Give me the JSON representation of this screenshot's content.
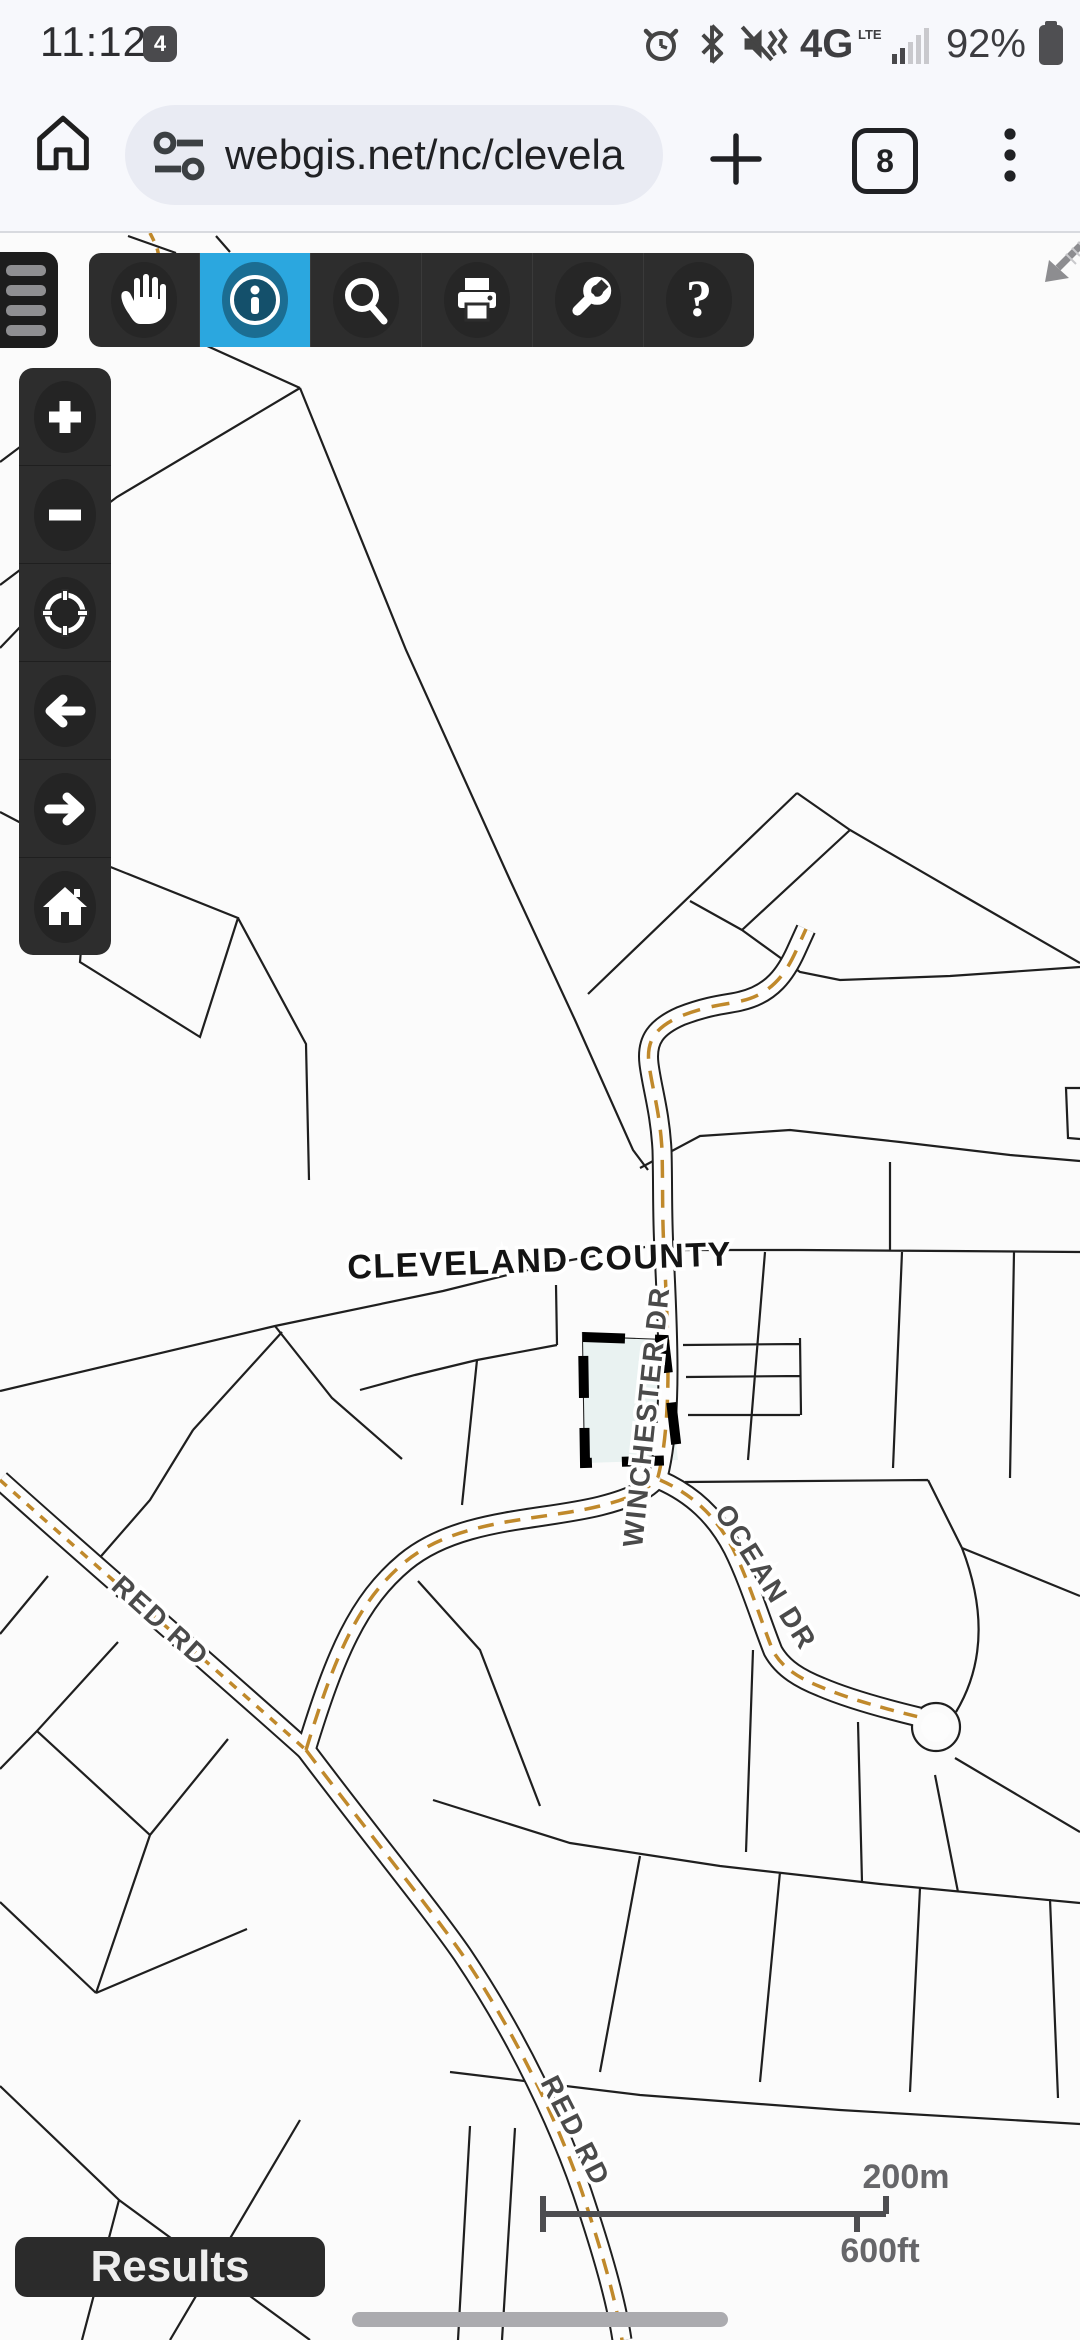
{
  "status_bar": {
    "time": "11:12",
    "notification_badge": "4",
    "network": "4G",
    "network_sub": "LTE",
    "battery_percent": "92%"
  },
  "browser_bar": {
    "url": "webgis.net/nc/clevela",
    "tab_count": "8"
  },
  "map_toolbar": {
    "tools": [
      "pan",
      "identify",
      "search",
      "print",
      "tools",
      "help"
    ],
    "active_tool": "identify"
  },
  "nav_toolbar": {
    "tools": [
      "zoom-in",
      "zoom-out",
      "locate",
      "back",
      "forward",
      "home"
    ]
  },
  "map": {
    "county_label": "CLEVELAND COUNTY",
    "road_labels": {
      "winchester": "WINCHESTER DR",
      "ocean": "OCEAN DR",
      "red_upper": "RED RD",
      "red_lower": "RED RD"
    },
    "scale_bar": {
      "metric": "200m",
      "imperial": "600ft"
    }
  },
  "results_panel": {
    "label": "Results"
  },
  "colors": {
    "accent_blue": "#2BA7DF",
    "toolbar_dark": "#2D2D2D",
    "road_centerline": "#C0892B",
    "selection_fill": "#E9F2F1",
    "parcel_line": "#1F1F1F"
  }
}
